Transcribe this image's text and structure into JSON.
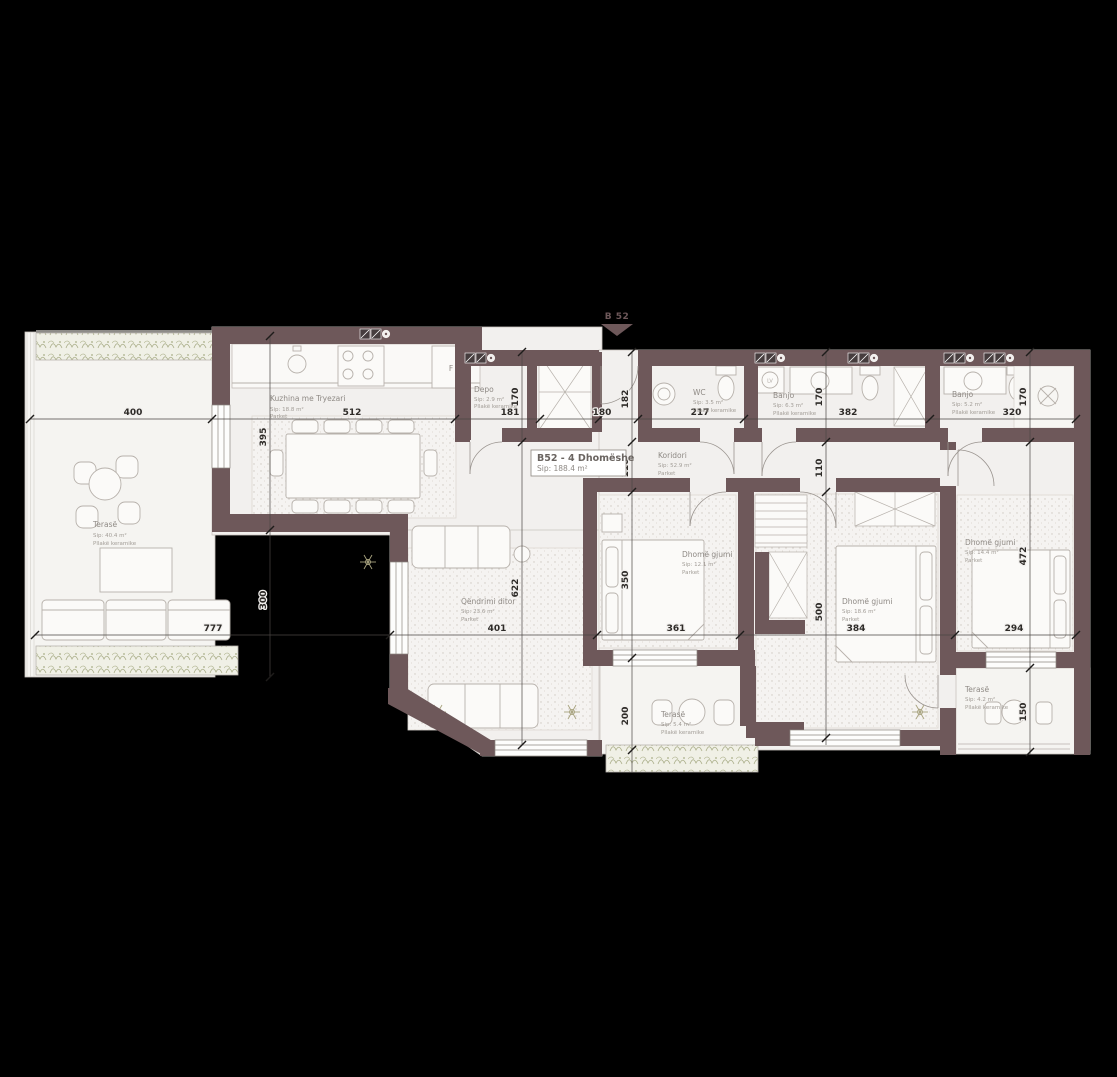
{
  "marker": {
    "label": "B 52"
  },
  "title_block": {
    "name": "B52 - 4 Dhomëshe",
    "area": "Sip: 188.4 m²"
  },
  "rooms": {
    "terrace_left": {
      "name": "Terasë",
      "area": "Sip: 40.4 m²",
      "floor": "Pllakë keramike"
    },
    "kitchen": {
      "name": "Kuzhina me Tryezari",
      "area": "Sip: 18.8 m²",
      "floor": "Parket"
    },
    "depo": {
      "name": "Depo",
      "area": "Sip: 2.9 m²",
      "floor": "Pllakë keramike"
    },
    "wc": {
      "name": "WC",
      "area": "Sip: 3.5 m²",
      "floor": "Pllakë keramike"
    },
    "bath1": {
      "name": "Banjo",
      "area": "Sip: 6.3 m²",
      "floor": "Pllakë keramike"
    },
    "bath2": {
      "name": "Banjo",
      "area": "Sip: 5.2 m²",
      "floor": "Pllakë keramike"
    },
    "corridor": {
      "name": "Koridori",
      "area": "Sip: 52.9 m²",
      "floor": "Parket"
    },
    "living": {
      "name": "Qëndrimi ditor",
      "area": "Sip: 23.6 m²",
      "floor": "Parket"
    },
    "bedroom1": {
      "name": "Dhomë gjumi",
      "area": "Sip: 12.1 m²",
      "floor": "Parket"
    },
    "bedroom2": {
      "name": "Dhomë gjumi",
      "area": "Sip: 18.6 m²",
      "floor": "Parket"
    },
    "bedroom3": {
      "name": "Dhomë gjumi",
      "area": "Sip: 14.4 m²",
      "floor": "Parket"
    },
    "terrace_mid": {
      "name": "Terasë",
      "area": "Sip: 5.4 m²",
      "floor": "Pllakë keramike"
    },
    "terrace_right": {
      "name": "Terasë",
      "area": "Sip: 4.2 m²",
      "floor": "Pllakë keramike"
    }
  },
  "dimensions": {
    "top": [
      "400",
      "512",
      "181",
      "180",
      "217",
      "382",
      "320"
    ],
    "mid": [
      "777",
      "401",
      "361",
      "384",
      "294"
    ],
    "vertical": {
      "v395": "395",
      "v300": "300",
      "v170a": "170",
      "v622": "622",
      "v182": "182",
      "v110a": "110",
      "v350": "350",
      "v200": "200",
      "v170b": "170",
      "v110b": "110",
      "v500": "500",
      "v170c": "170",
      "v472": "472",
      "v150": "150"
    }
  },
  "fixtures": {
    "fridge": "F",
    "washer": "LV"
  },
  "colors": {
    "wall": "#6e585a",
    "floor": "#f2f0ee",
    "background": "#000000"
  }
}
